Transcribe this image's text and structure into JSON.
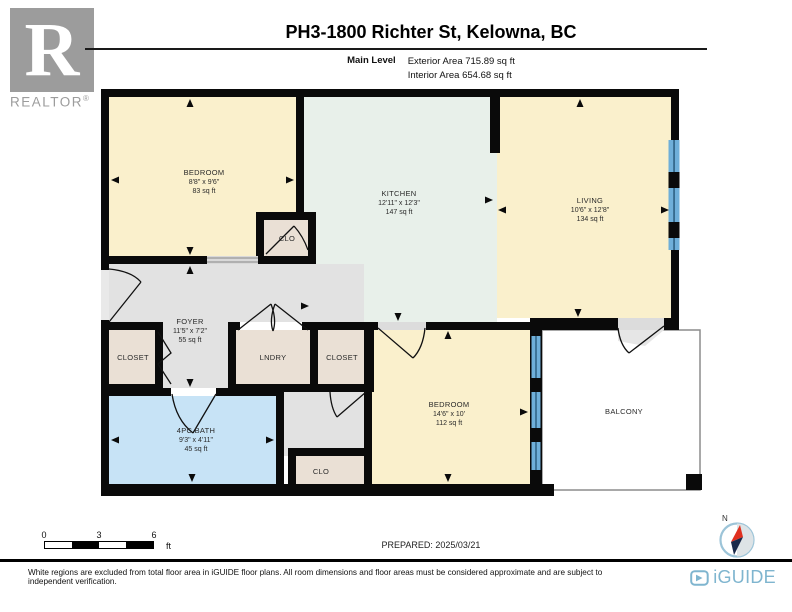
{
  "header": {
    "title": "PH3-1800 Richter St, Kelowna, BC",
    "level_label": "Main Level",
    "exterior_area": "Exterior Area 715.89 sq ft",
    "interior_area": "Interior Area 654.68 sq ft"
  },
  "branding": {
    "realtor_r": "R",
    "realtor_text": "REALTOR",
    "reg_mark": "®",
    "iguide_text": "iGUIDE"
  },
  "rooms": {
    "bedroom1": {
      "name": "BEDROOM",
      "dims": "8'8\" x 9'6\"",
      "area": "83 sq ft"
    },
    "kitchen": {
      "name": "KITCHEN",
      "dims": "12'11\" x 12'3\"",
      "area": "147 sq ft"
    },
    "living": {
      "name": "LIVING",
      "dims": "10'6\" x 12'8\"",
      "area": "134 sq ft"
    },
    "foyer": {
      "name": "FOYER",
      "dims": "11'5\" x 7'2\"",
      "area": "55 sq ft"
    },
    "clo_top": {
      "name": "CLO"
    },
    "closet_left": {
      "name": "CLOSET"
    },
    "laundry": {
      "name": "LNDRY"
    },
    "closet_right": {
      "name": "CLOSET"
    },
    "bath": {
      "name": "4PC BATH",
      "dims": "9'3\" x 4'11\"",
      "area": "45 sq ft"
    },
    "clo_bottom": {
      "name": "CLO"
    },
    "bedroom2": {
      "name": "BEDROOM",
      "dims": "14'6\" x 10'",
      "area": "112 sq ft"
    },
    "balcony": {
      "name": "BALCONY"
    }
  },
  "scale_bar": {
    "ticks": [
      "0",
      "3",
      "6"
    ],
    "unit": "ft"
  },
  "compass": {
    "north_label": "N"
  },
  "footer": {
    "prepared": "PREPARED: 2025/03/21",
    "disclaimer": "White regions are excluded from total floor area in iGUIDE floor plans. All room dimensions and floor areas must be considered approximate and are subject to independent verification."
  },
  "colors": {
    "wall": "#0A0A0A",
    "bedroom_fill": "#FAF0CC",
    "kitchen_fill": "#E8F0EA",
    "foyer_fill": "#E2E2E2",
    "closet_fill": "#EAE0D5",
    "bath_fill": "#C7E3F6",
    "window_blue": "#6FAFD9",
    "balcony_border": "#8C8C8C",
    "iguide_blue": "#7FB5CF",
    "realtor_grey": "#9B9B9B"
  }
}
